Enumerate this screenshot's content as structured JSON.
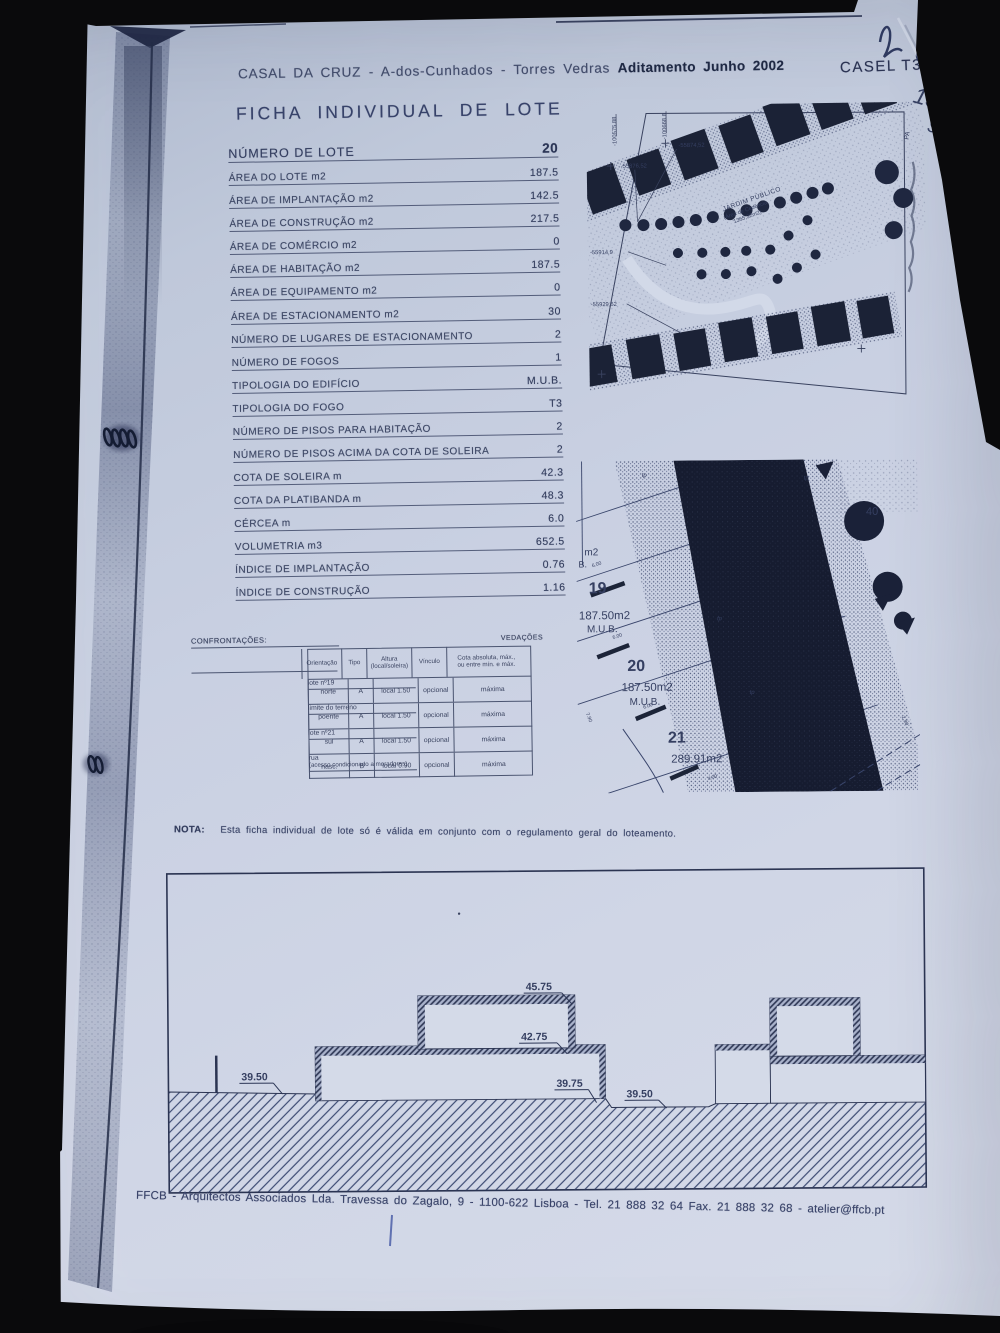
{
  "header": {
    "location_line": "CASAL DA CRUZ  -  A-dos-Cunhados  -  Torres Vedras",
    "addendum": "Aditamento Junho 2002",
    "ref_code": "CASEL T3",
    "handwritten_number": "151",
    "handwritten_letter": "9"
  },
  "title": "FICHA INDIVIDUAL DE LOTE",
  "fields": [
    {
      "label": "NÚMERO DE LOTE",
      "value": "20"
    },
    {
      "label": "ÁREA DO LOTE m2",
      "value": "187.5"
    },
    {
      "label": "ÁREA DE IMPLANTAÇÃO m2",
      "value": "142.5"
    },
    {
      "label": "ÁREA DE CONSTRUÇÃO m2",
      "value": "217.5"
    },
    {
      "label": "ÁREA DE COMÉRCIO m2",
      "value": "0"
    },
    {
      "label": "ÁREA DE HABITAÇÃO m2",
      "value": "187.5"
    },
    {
      "label": "ÁREA DE EQUIPAMENTO m2",
      "value": "0"
    },
    {
      "label": "ÁREA DE ESTACIONAMENTO m2",
      "value": "30"
    },
    {
      "label": "NÚMERO DE LUGARES DE ESTACIONAMENTO",
      "value": "2"
    },
    {
      "label": "NÚMERO DE FOGOS",
      "value": "1"
    },
    {
      "label": "TIPOLOGIA DO EDIFÍCIO",
      "value": "M.U.B."
    },
    {
      "label": "TIPOLOGIA DO FOGO",
      "value": "T3"
    },
    {
      "label": "NÚMERO DE PISOS PARA HABITAÇÃO",
      "value": "2"
    },
    {
      "label": "NÚMERO DE PISOS ACIMA DA COTA DE SOLEIRA",
      "value": "2"
    },
    {
      "label": "COTA DE SOLEIRA m",
      "value": "42.3"
    },
    {
      "label": "COTA DA PLATIBANDA m",
      "value": "48.3"
    },
    {
      "label": "CÉRCEA m",
      "value": "6.0"
    },
    {
      "label": "VOLUMETRIA m3",
      "value": "652.5"
    },
    {
      "label": "ÍNDICE DE IMPLANTAÇÃO",
      "value": "0.76"
    },
    {
      "label": "ÍNDICE DE CONSTRUÇÃO",
      "value": "1.16"
    }
  ],
  "site_plan": {
    "garden_1": "JARDIM PÚBLICO",
    "garden_2": "(Área de Cedência",
    "garden_3": "1365,32m2)",
    "coords": {
      "c1": "-100575.88",
      "c2": "-100668.8",
      "c3": "-55874,52",
      "c4": "-55876,52",
      "c5": "-55914,9",
      "c6": "-55929,62"
    },
    "edge_label": "PA"
  },
  "lot_plan": {
    "partial_area_unit": "m2",
    "partial_type": "B.",
    "lot19": {
      "num": "19",
      "area": "187.50m2",
      "type": "M.U.B."
    },
    "lot20": {
      "num": "20",
      "area": "187.50m2",
      "type": "M.U.B."
    },
    "lot21": {
      "num": "21",
      "area": "289.91m2"
    },
    "corner_number": "40",
    "dims": {
      "d600": "6.00",
      "d790": "7.90",
      "d290": "2.90",
      "d400": "4.00"
    },
    "tp": "tp",
    "fp": "fp"
  },
  "confrontacoes": {
    "title": "CONFRONTAÇÕES:",
    "vedacoes_title": "VEDAÇÕES",
    "col_orientacao": "Orientação",
    "col_tipo": "Tipo",
    "col_altura_1": "Altura",
    "col_altura_2": "(local/soleira)",
    "col_vinculo": "Vínculo",
    "col_cota_1": "Cota absoluta, máx.,",
    "col_cota_2": "ou entre mín. e máx.",
    "rows": [
      {
        "side": "lote nº19",
        "side2": "",
        "orient": "norte",
        "tipo": "A",
        "altura": "local 1.50",
        "vinculo": "opcional",
        "cota": "máxima"
      },
      {
        "side": "limite do terreno",
        "side2": "",
        "orient": "poente",
        "tipo": "A",
        "altura": "local 1.50",
        "vinculo": "opcional",
        "cota": "máxima"
      },
      {
        "side": "lote nº21",
        "side2": "",
        "orient": "sul",
        "tipo": "A",
        "altura": "local 1.50",
        "vinculo": "opcional",
        "cota": "máxima"
      },
      {
        "side": "rua",
        "side2": "(acesso condicionado a moradores)",
        "orient": "nasc.",
        "tipo": "B",
        "altura": "local 0.90",
        "vinculo": "opcional",
        "cota": "máxima"
      }
    ]
  },
  "nota": {
    "label": "NOTA:",
    "text": "Esta ficha individual de lote só é válida em conjunto com o regulamento geral do loteamento."
  },
  "elevation": {
    "levels": {
      "top": "45.75",
      "middle": "42.75",
      "ground_left": "39.50",
      "ground_mid": "39.75",
      "ground_right": "39.50"
    }
  },
  "footer": "FFCB  -  Arquitectos Associados Lda. Travessa do Zagalo, 9  -  1100-622 Lisboa  -  Tel. 21 888 32 64 Fax. 21 888 32 68  -  atelier@ffcb.pt"
}
